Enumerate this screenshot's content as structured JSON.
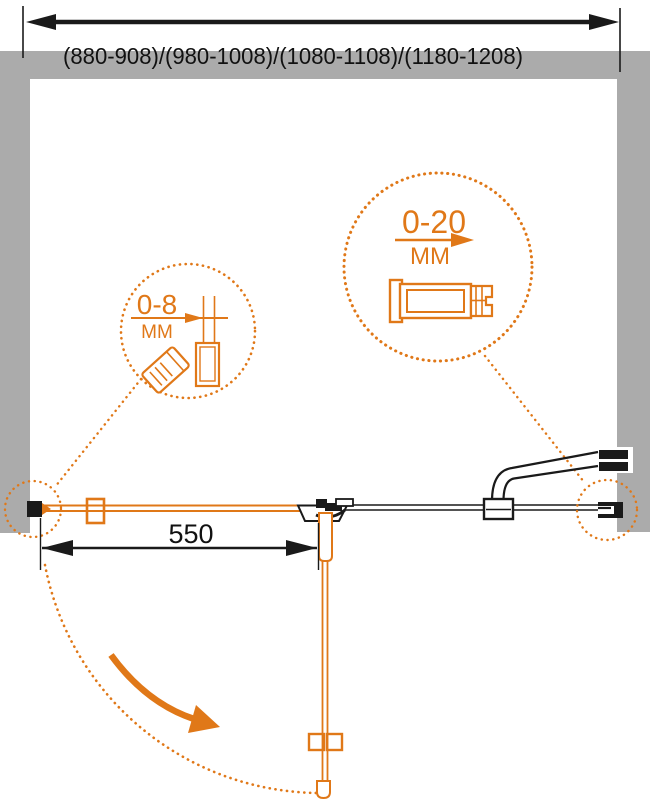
{
  "labels": {
    "overall_width_ranges": "(880-908)/(980-1008)/(1080-1108)/(1180-1208)",
    "door_width": "550",
    "detail_small_range": "0-8",
    "detail_small_unit": "MM",
    "detail_large_range": "0-20",
    "detail_large_unit": "MM"
  },
  "dimensions_mm": {
    "overall_width_options": [
      [
        880,
        908
      ],
      [
        980,
        1008
      ],
      [
        1080,
        1108
      ],
      [
        1180,
        1208
      ]
    ],
    "door_width": 550,
    "adjustment_range_small": [
      0,
      8
    ],
    "adjustment_range_large": [
      0,
      20
    ]
  },
  "colors": {
    "accent_orange": "#E07818",
    "wall_gray": "#ABABAB",
    "ink": "#1A1A1A"
  }
}
